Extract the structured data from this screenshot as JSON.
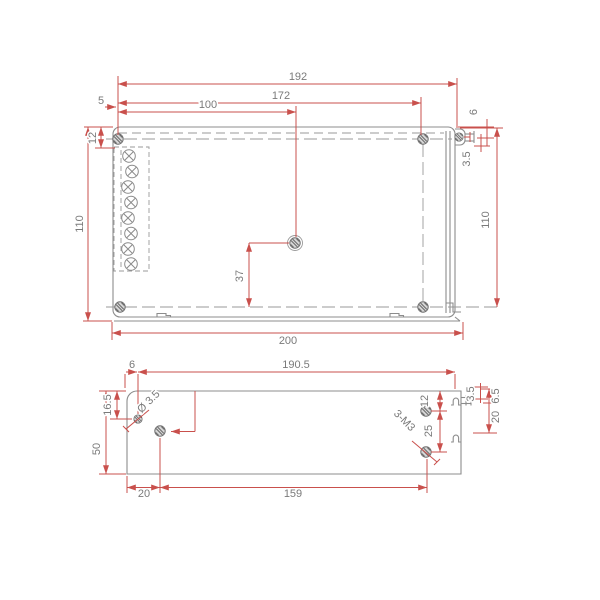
{
  "drawing_type": "mechanical-dimension-drawing",
  "colors": {
    "dimension_line": "#c9504c",
    "geometry_line": "#8c8c8c",
    "label_text": "#7a7a7a",
    "background": "#ffffff"
  },
  "top": {
    "w192": "192",
    "w172": "172",
    "w100": "100",
    "off5": "5",
    "h12": "12",
    "h110_left": "110",
    "h110_right": "110",
    "h6": "6",
    "h3_5": "3.5",
    "h37": "37",
    "w200": "200"
  },
  "bottom": {
    "off6": "6",
    "w190_5": "190.5",
    "h16_5": "16.5",
    "h50": "50",
    "hole_dia": "Ø 3.5",
    "h12": "12",
    "h25": "25",
    "thread": "3-M3",
    "p3_5": "3.5",
    "p6_5": "6.5",
    "p20": "20",
    "w20": "20",
    "w159": "159"
  }
}
